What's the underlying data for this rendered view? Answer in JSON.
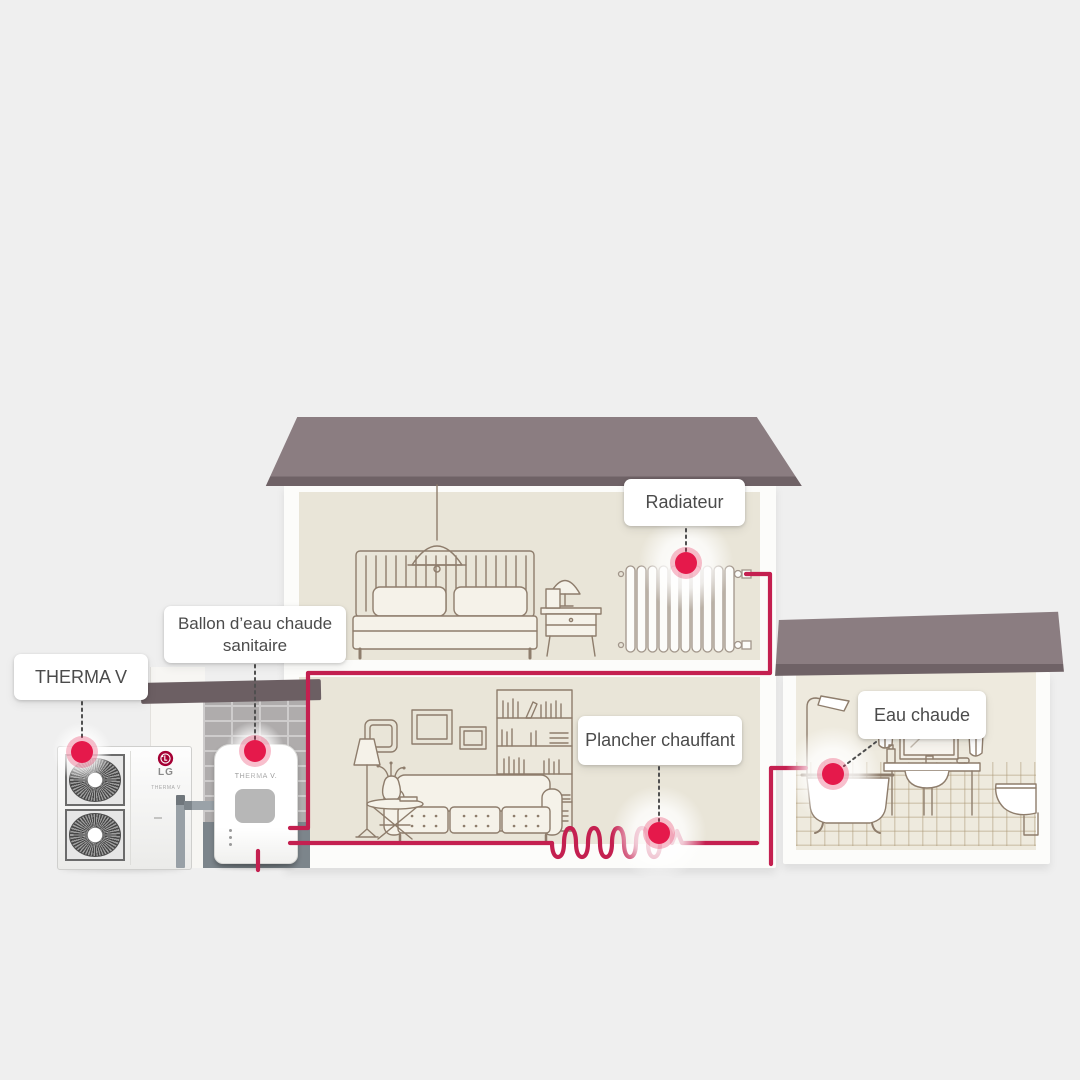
{
  "diagram": {
    "hotspots": [
      {
        "id": "therma_v",
        "label": "THERMA V"
      },
      {
        "id": "ballon",
        "label": "Ballon d’eau chaude sanitaire"
      },
      {
        "id": "radiateur",
        "label": "Radiateur"
      },
      {
        "id": "plancher_chauffant",
        "label": "Plancher chauffant"
      },
      {
        "id": "eau_chaude",
        "label": "Eau chaude"
      }
    ],
    "devices": {
      "outdoor_unit_brand": "LG",
      "outdoor_unit_text": "THERMA V",
      "tank_text": "THERMA V."
    },
    "colors": {
      "background": "#efefef",
      "accent_red": "#e5194b",
      "pipe_red": "#c42050",
      "lg_brand_red": "#a50034",
      "roof_taupe": "#8b7d81",
      "interior_beige": "#e9e5d8",
      "outline_brown": "#8e7d6c"
    }
  }
}
